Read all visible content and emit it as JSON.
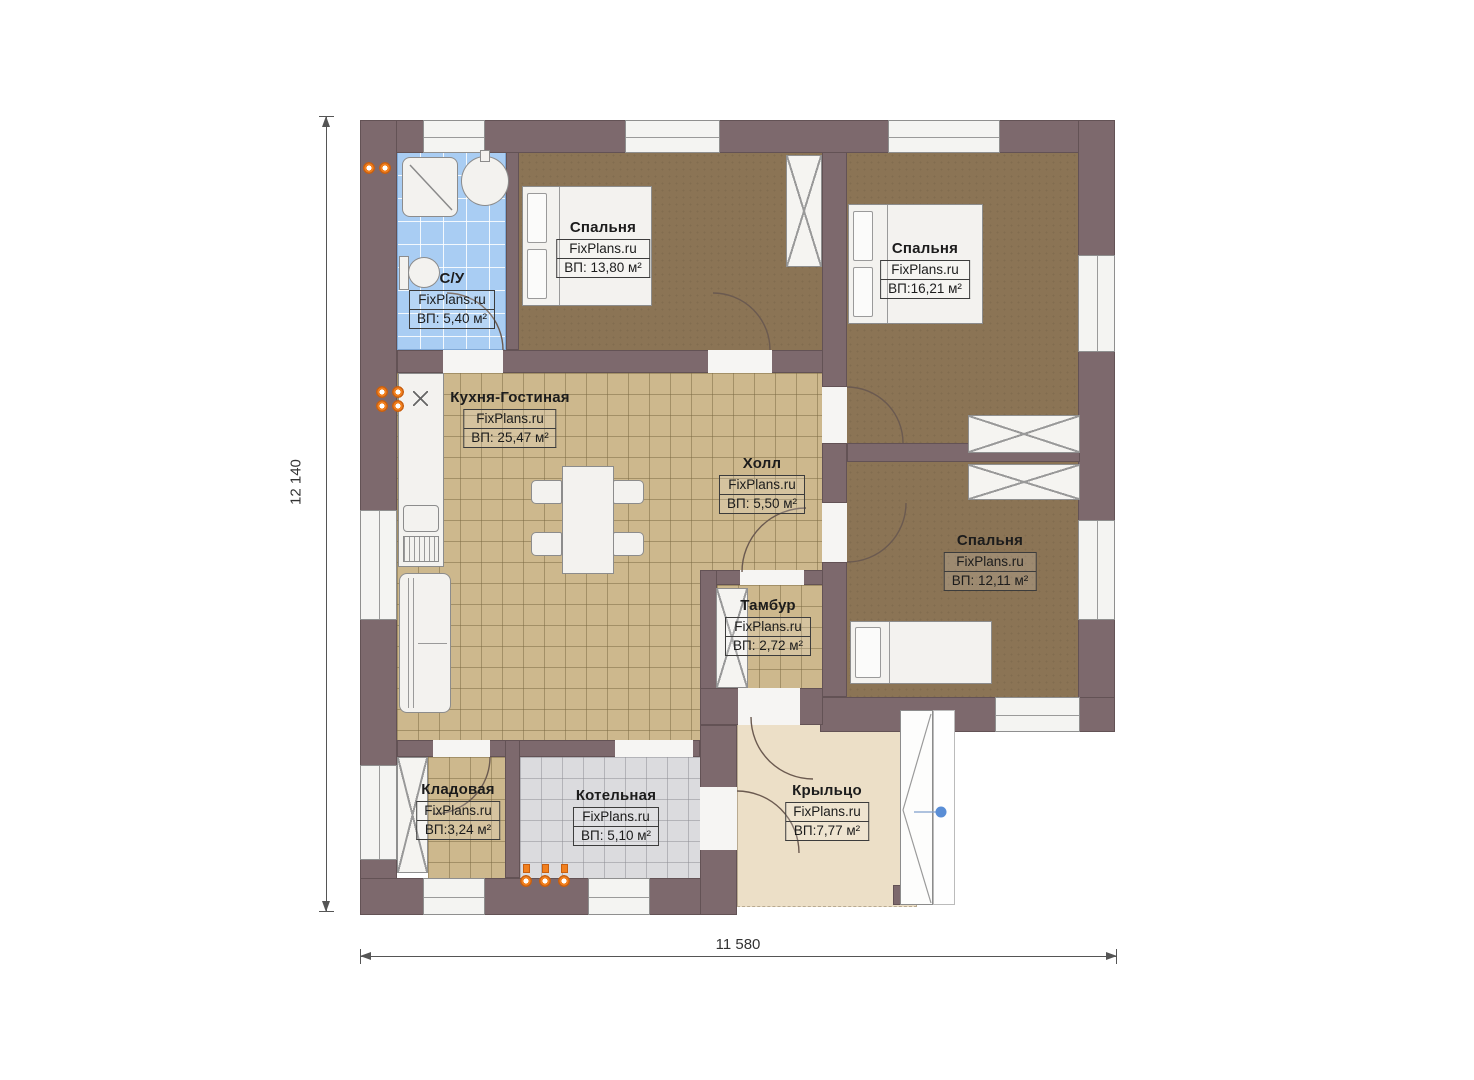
{
  "plan": {
    "brand": "FixPlans.ru",
    "rooms": [
      {
        "id": "bathroom",
        "name": "С/У",
        "watermark": "FixPlans.ru",
        "area": "ВП: 5,40 м²"
      },
      {
        "id": "bedroom-1",
        "name": "Спальня",
        "watermark": "FixPlans.ru",
        "area": "ВП: 13,80 м²"
      },
      {
        "id": "bedroom-2",
        "name": "Спальня",
        "watermark": "FixPlans.ru",
        "area": "ВП:16,21 м²"
      },
      {
        "id": "kitchen-living",
        "name": "Кухня-Гостиная",
        "watermark": "FixPlans.ru",
        "area": "ВП: 25,47 м²"
      },
      {
        "id": "hall",
        "name": "Холл",
        "watermark": "FixPlans.ru",
        "area": "ВП: 5,50 м²"
      },
      {
        "id": "bedroom-3",
        "name": "Спальня",
        "watermark": "FixPlans.ru",
        "area": "ВП: 12,11 м²"
      },
      {
        "id": "vestibule",
        "name": "Тамбур",
        "watermark": "FixPlans.ru",
        "area": "ВП: 2,72 м²"
      },
      {
        "id": "storage",
        "name": "Кладовая",
        "watermark": "FixPlans.ru",
        "area": "ВП:3,24 м²"
      },
      {
        "id": "boiler-room",
        "name": "Котельная",
        "watermark": "FixPlans.ru",
        "area": "ВП: 5,10 м²"
      },
      {
        "id": "porch",
        "name": "Крыльцо",
        "watermark": "FixPlans.ru",
        "area": "ВП:7,77 м²"
      }
    ],
    "dimensions": {
      "height_label": "12 140",
      "width_label": "11 580"
    },
    "colors": {
      "wall": "#7d696d",
      "bedroom_floor": "#8b7455",
      "kitchen_tile": "#cdb88d",
      "bathroom_tile": "#a9cdf3",
      "boiler_tile": "#dbdbde",
      "porch_floor": "#ecdfc7",
      "radiator": "#f2801e",
      "marker_dot": "#5a8ed6"
    }
  }
}
